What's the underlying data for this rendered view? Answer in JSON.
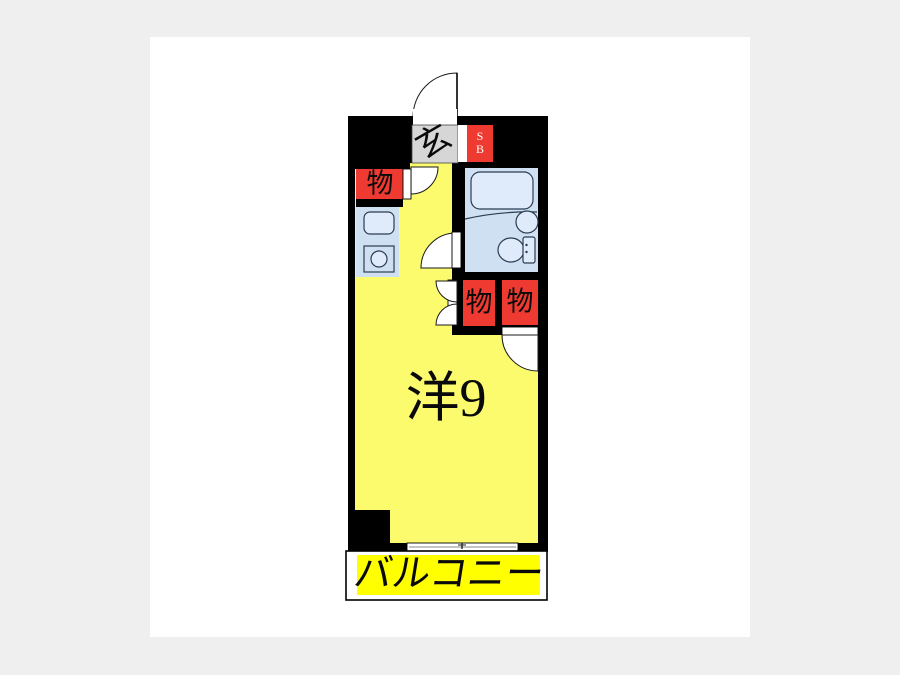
{
  "floorplan": {
    "labels": {
      "entrance": "玄",
      "shoebox_top": "S",
      "shoebox_bottom": "B",
      "storage_1": "物",
      "storage_2": "物",
      "storage_3": "物",
      "room": "洋9",
      "balcony": "バルコニー"
    },
    "colors": {
      "page_bg": "#efefef",
      "canvas_bg": "#ffffff",
      "wall": "#000000",
      "room": "#fcfb6e",
      "balcony": "#ffff00",
      "accent_red": "#ee3a30",
      "entrance_gray": "#d6d6d6",
      "bath": "#cfe0f2",
      "fixture": "#dfeafa",
      "fixline": "#2b3c52"
    }
  }
}
